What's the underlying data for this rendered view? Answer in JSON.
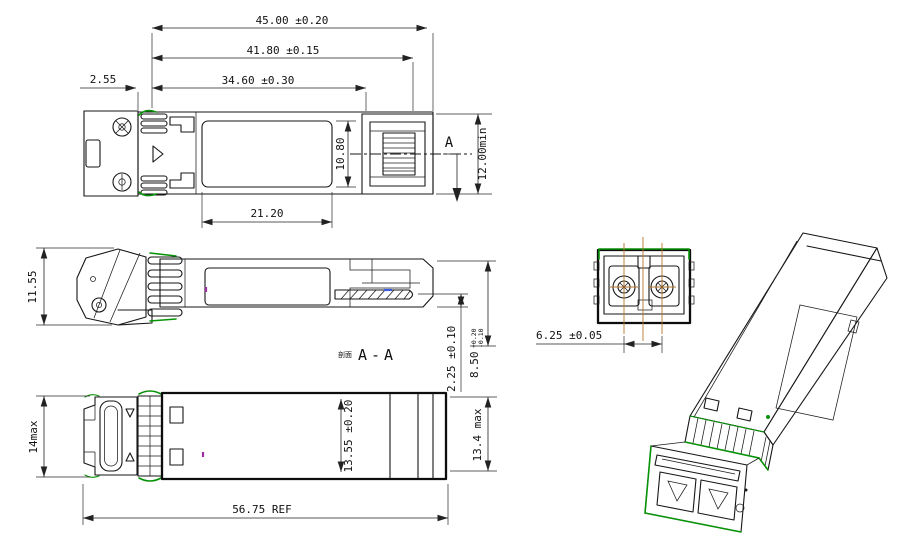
{
  "colors": {
    "line": "#161616",
    "accent_green": "#079307",
    "centerline_orange": "#b5762a",
    "highlight_blue": "#3a5bdc",
    "highlight_purple": "#9a30a0"
  },
  "top_view": {
    "dim_overall_length": "45.00 ±0.20",
    "dim_body_length": "41.80 ±0.15",
    "dim_latch_length": "34.60 ±0.30",
    "dim_offset": "2.55",
    "dim_label_length": "21.20",
    "dim_label_width": "10.80",
    "dim_panel_min": "12.00min",
    "section_mark": "A"
  },
  "section_view": {
    "dim_height_left": "11.55",
    "dim_tongue_offset": "2.25 ±0.10",
    "dim_height": "8.50",
    "dim_height_tol_plus": "+0.20",
    "dim_height_tol_minus": "-0.10",
    "section_label_prefix": "剖面",
    "section_label": "A-A"
  },
  "bottom_view": {
    "dim_front_height": "14max",
    "dim_body_width": "13.55 ±0.20",
    "dim_max_width": "13.4 max",
    "dim_ref_length": "56.75 REF"
  },
  "front_view": {
    "dim_lc_pitch": "6.25 ±0.05"
  }
}
